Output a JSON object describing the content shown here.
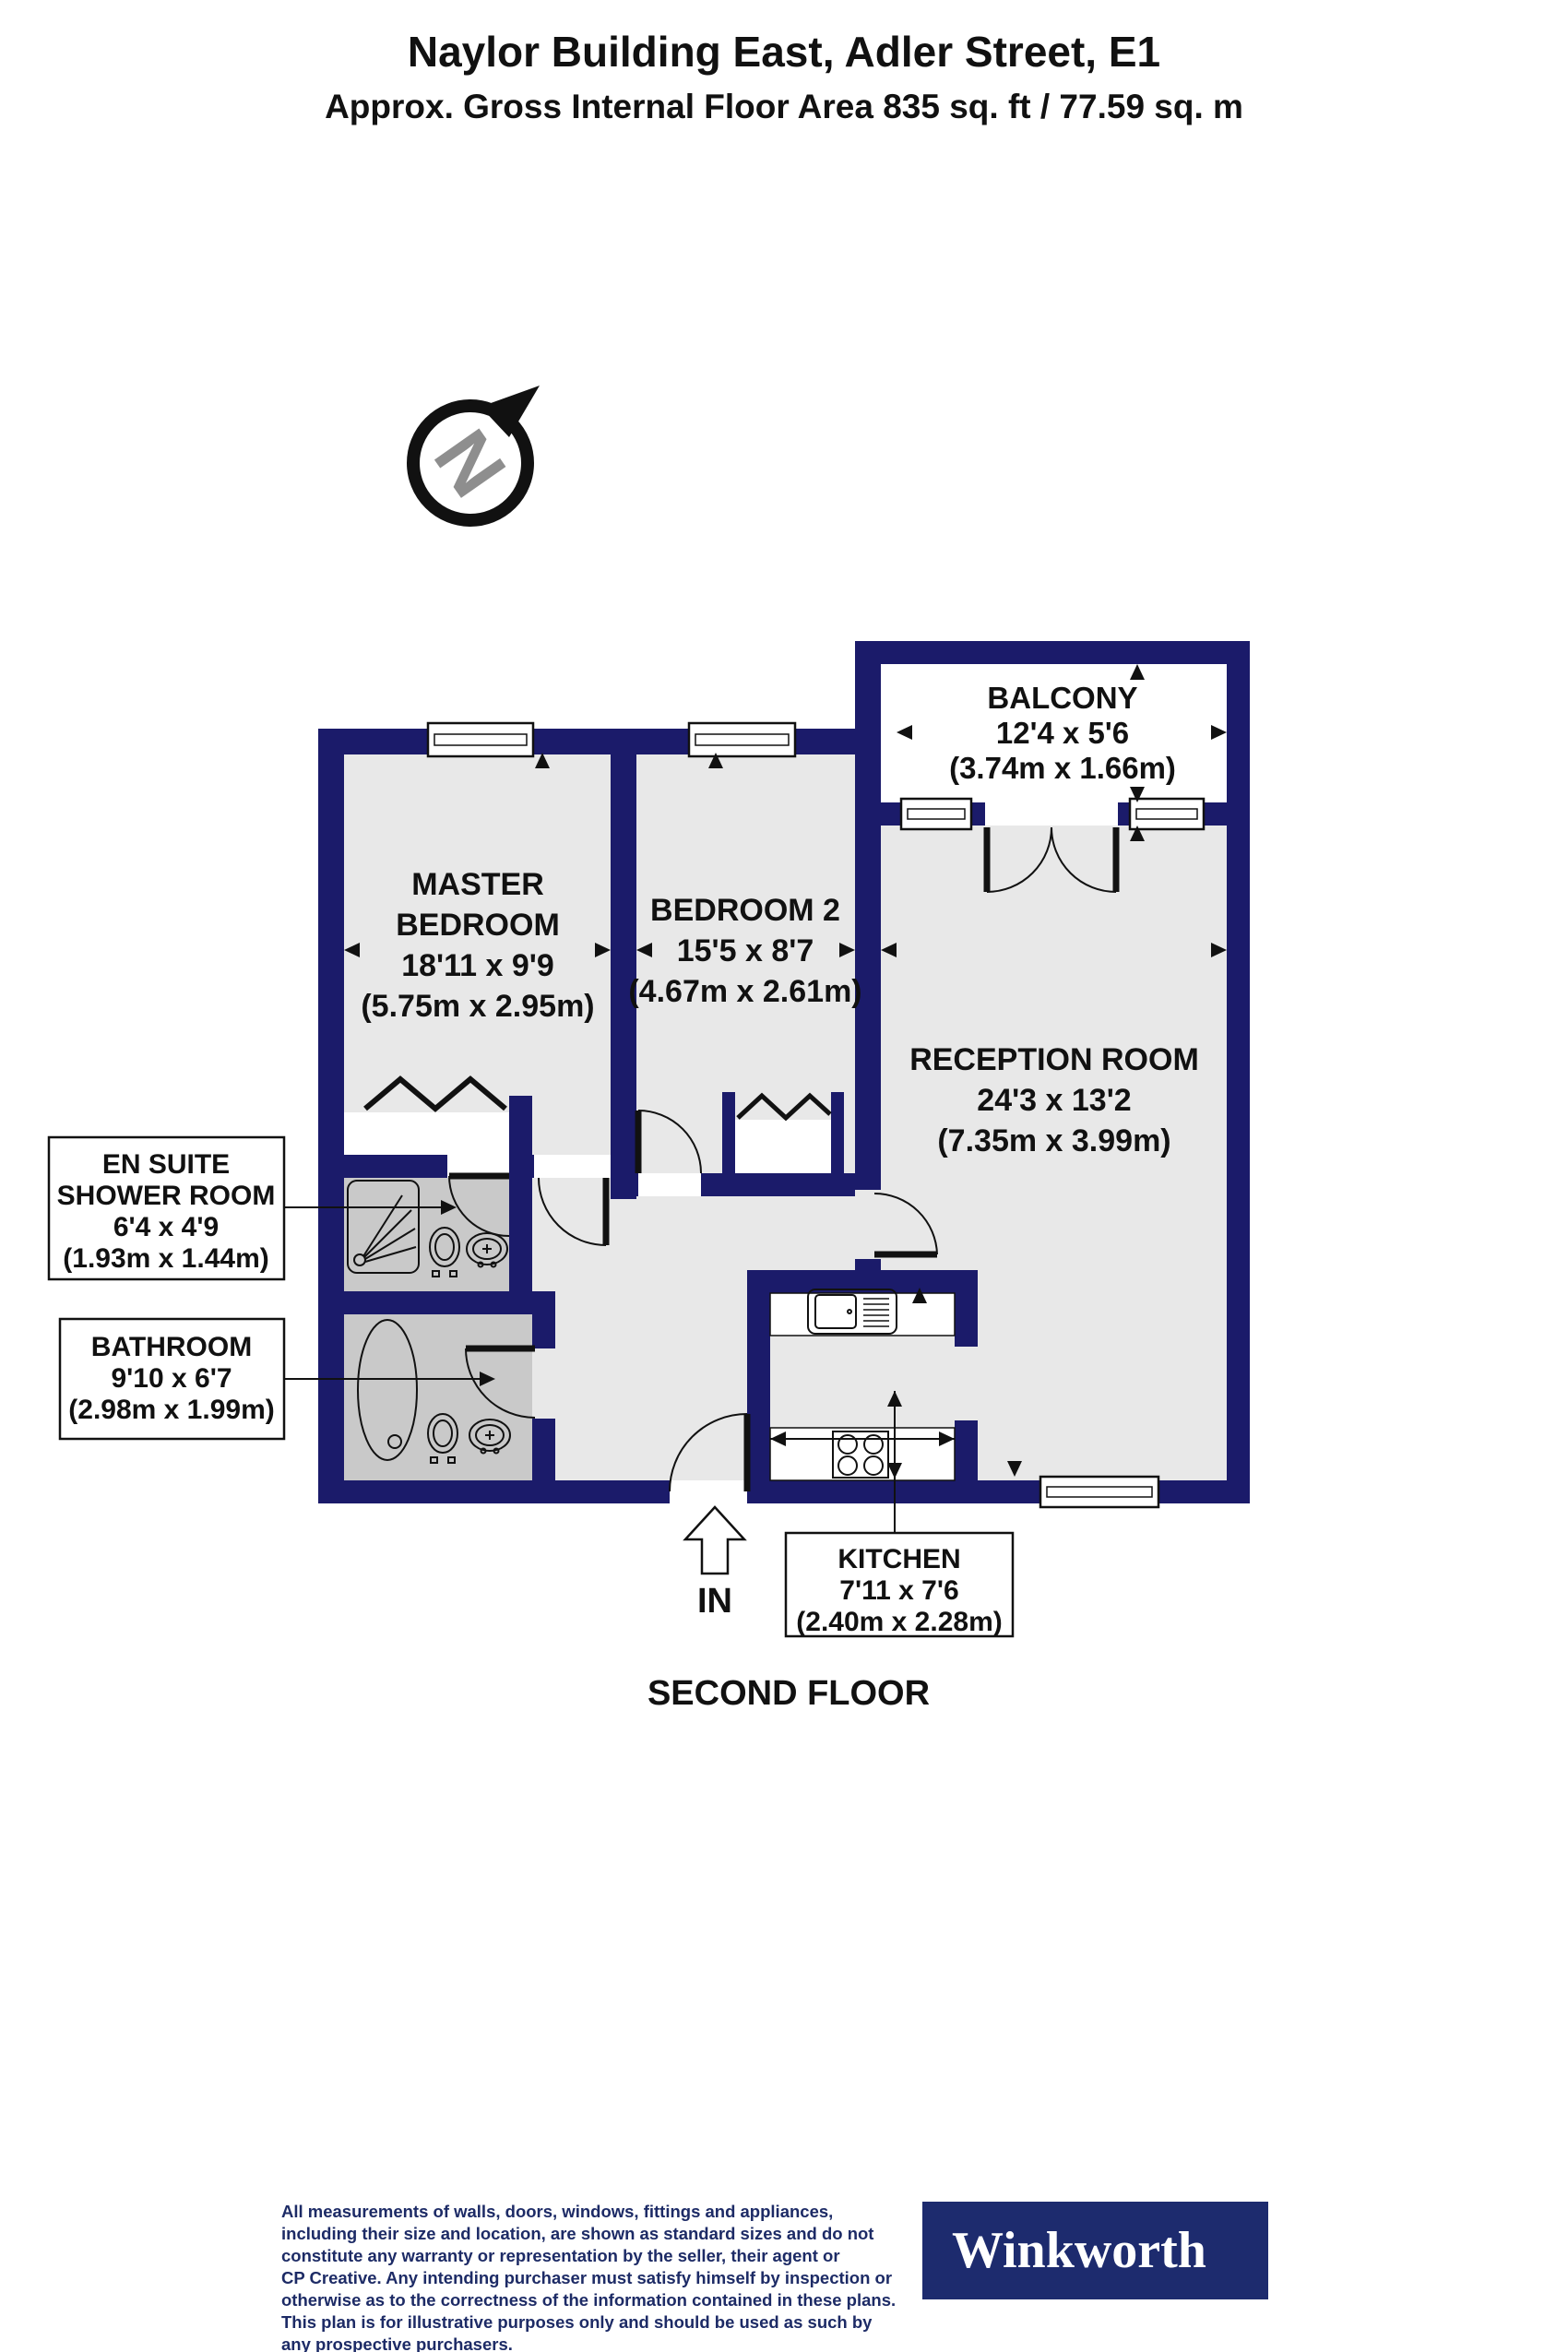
{
  "header": {
    "title": "Naylor Building East, Adler Street, E1",
    "subtitle": "Approx. Gross Internal Floor Area 835 sq. ft / 77.59 sq. m"
  },
  "compass": {
    "letter": "N"
  },
  "plan": {
    "floor_label": "SECOND FLOOR",
    "entrance_label": "IN",
    "rooms": {
      "balcony": {
        "name": "BALCONY",
        "imperial": "12'4 x 5'6",
        "metric": "(3.74m x 1.66m)"
      },
      "master_bedroom": {
        "name_line1": "MASTER",
        "name_line2": "BEDROOM",
        "imperial": "18'11 x 9'9",
        "metric": "(5.75m x 2.95m)"
      },
      "bedroom_2": {
        "name": "BEDROOM 2",
        "imperial": "15'5 x 8'7",
        "metric": "(4.67m x 2.61m)"
      },
      "reception_room": {
        "name": "RECEPTION ROOM",
        "imperial": "24'3 x 13'2",
        "metric": "(7.35m x 3.99m)"
      },
      "en_suite_shower_room": {
        "name_line1": "EN SUITE",
        "name_line2": "SHOWER ROOM",
        "imperial": "6'4 x 4'9",
        "metric": "(1.93m x 1.44m)"
      },
      "bathroom": {
        "name": "BATHROOM",
        "imperial": "9'10 x 6'7",
        "metric": "(2.98m x 1.99m)"
      },
      "kitchen": {
        "name": "KITCHEN",
        "imperial": "7'11 x 7'6",
        "metric": "(2.40m x 2.28m)"
      }
    }
  },
  "footer": {
    "disclaimer_lines": [
      "All measurements of walls, doors, windows, fittings and appliances,",
      "including their size and location, are shown as standard sizes and do not",
      "constitute any warranty or representation by the seller, their agent or",
      "CP Creative. Any intending purchaser must satisfy himself by inspection or",
      "otherwise as to the correctness of the information contained in these plans.",
      "This plan is for illustrative purposes only and should be used as such by",
      "any prospective purchasers."
    ],
    "logo_text": "Winkworth"
  },
  "colors": {
    "wall": "#1b1b6a",
    "floor": "#e8e8e8",
    "wet_room_floor": "#c9c9c9",
    "line": "#111111",
    "disclaimer_text": "#1d2b66",
    "logo_background": "#1d2b6e",
    "compass_letter": "#8e8e8e"
  }
}
